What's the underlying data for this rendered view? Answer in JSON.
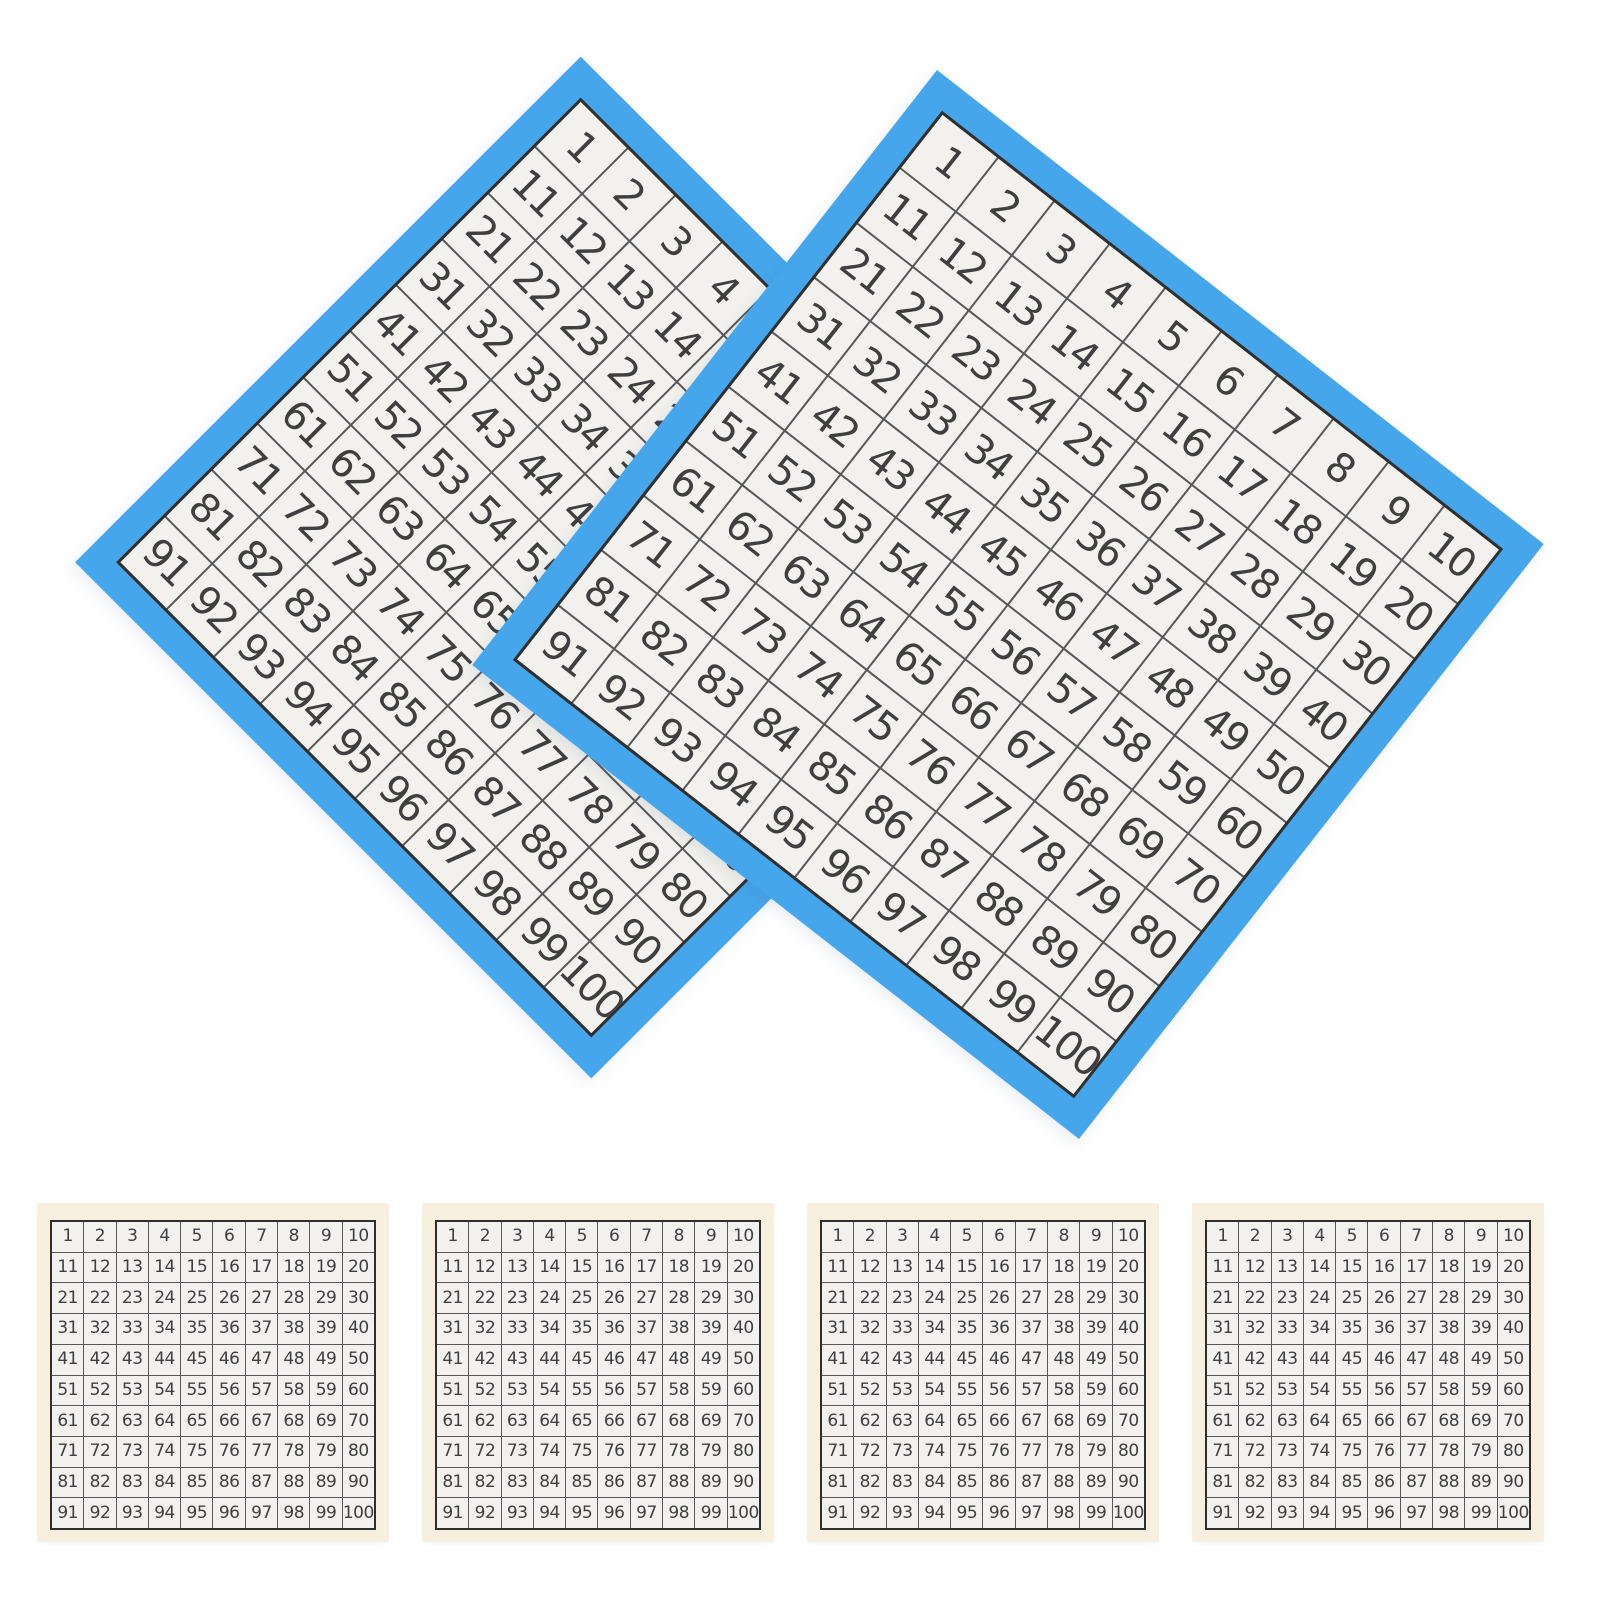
{
  "colors": {
    "background": "#ffffff",
    "card-blue": "#46a6ec",
    "cell-bg": "#f2f1ed",
    "grid-line": "#585858",
    "grid-border": "#2f2f2f",
    "digit": "#3f3f3f",
    "paper-edge": "#f8f0de"
  },
  "hundred_chart": {
    "rows": 10,
    "cols": 10,
    "numbers": [
      1,
      2,
      3,
      4,
      5,
      6,
      7,
      8,
      9,
      10,
      11,
      12,
      13,
      14,
      15,
      16,
      17,
      18,
      19,
      20,
      21,
      22,
      23,
      24,
      25,
      26,
      27,
      28,
      29,
      30,
      31,
      32,
      33,
      34,
      35,
      36,
      37,
      38,
      39,
      40,
      41,
      42,
      43,
      44,
      45,
      46,
      47,
      48,
      49,
      50,
      51,
      52,
      53,
      54,
      55,
      56,
      57,
      58,
      59,
      60,
      61,
      62,
      63,
      64,
      65,
      66,
      67,
      68,
      69,
      70,
      71,
      72,
      73,
      74,
      75,
      76,
      77,
      78,
      79,
      80,
      81,
      82,
      83,
      84,
      85,
      86,
      87,
      88,
      89,
      90,
      91,
      92,
      93,
      94,
      95,
      96,
      97,
      98,
      99,
      100
    ]
  }
}
